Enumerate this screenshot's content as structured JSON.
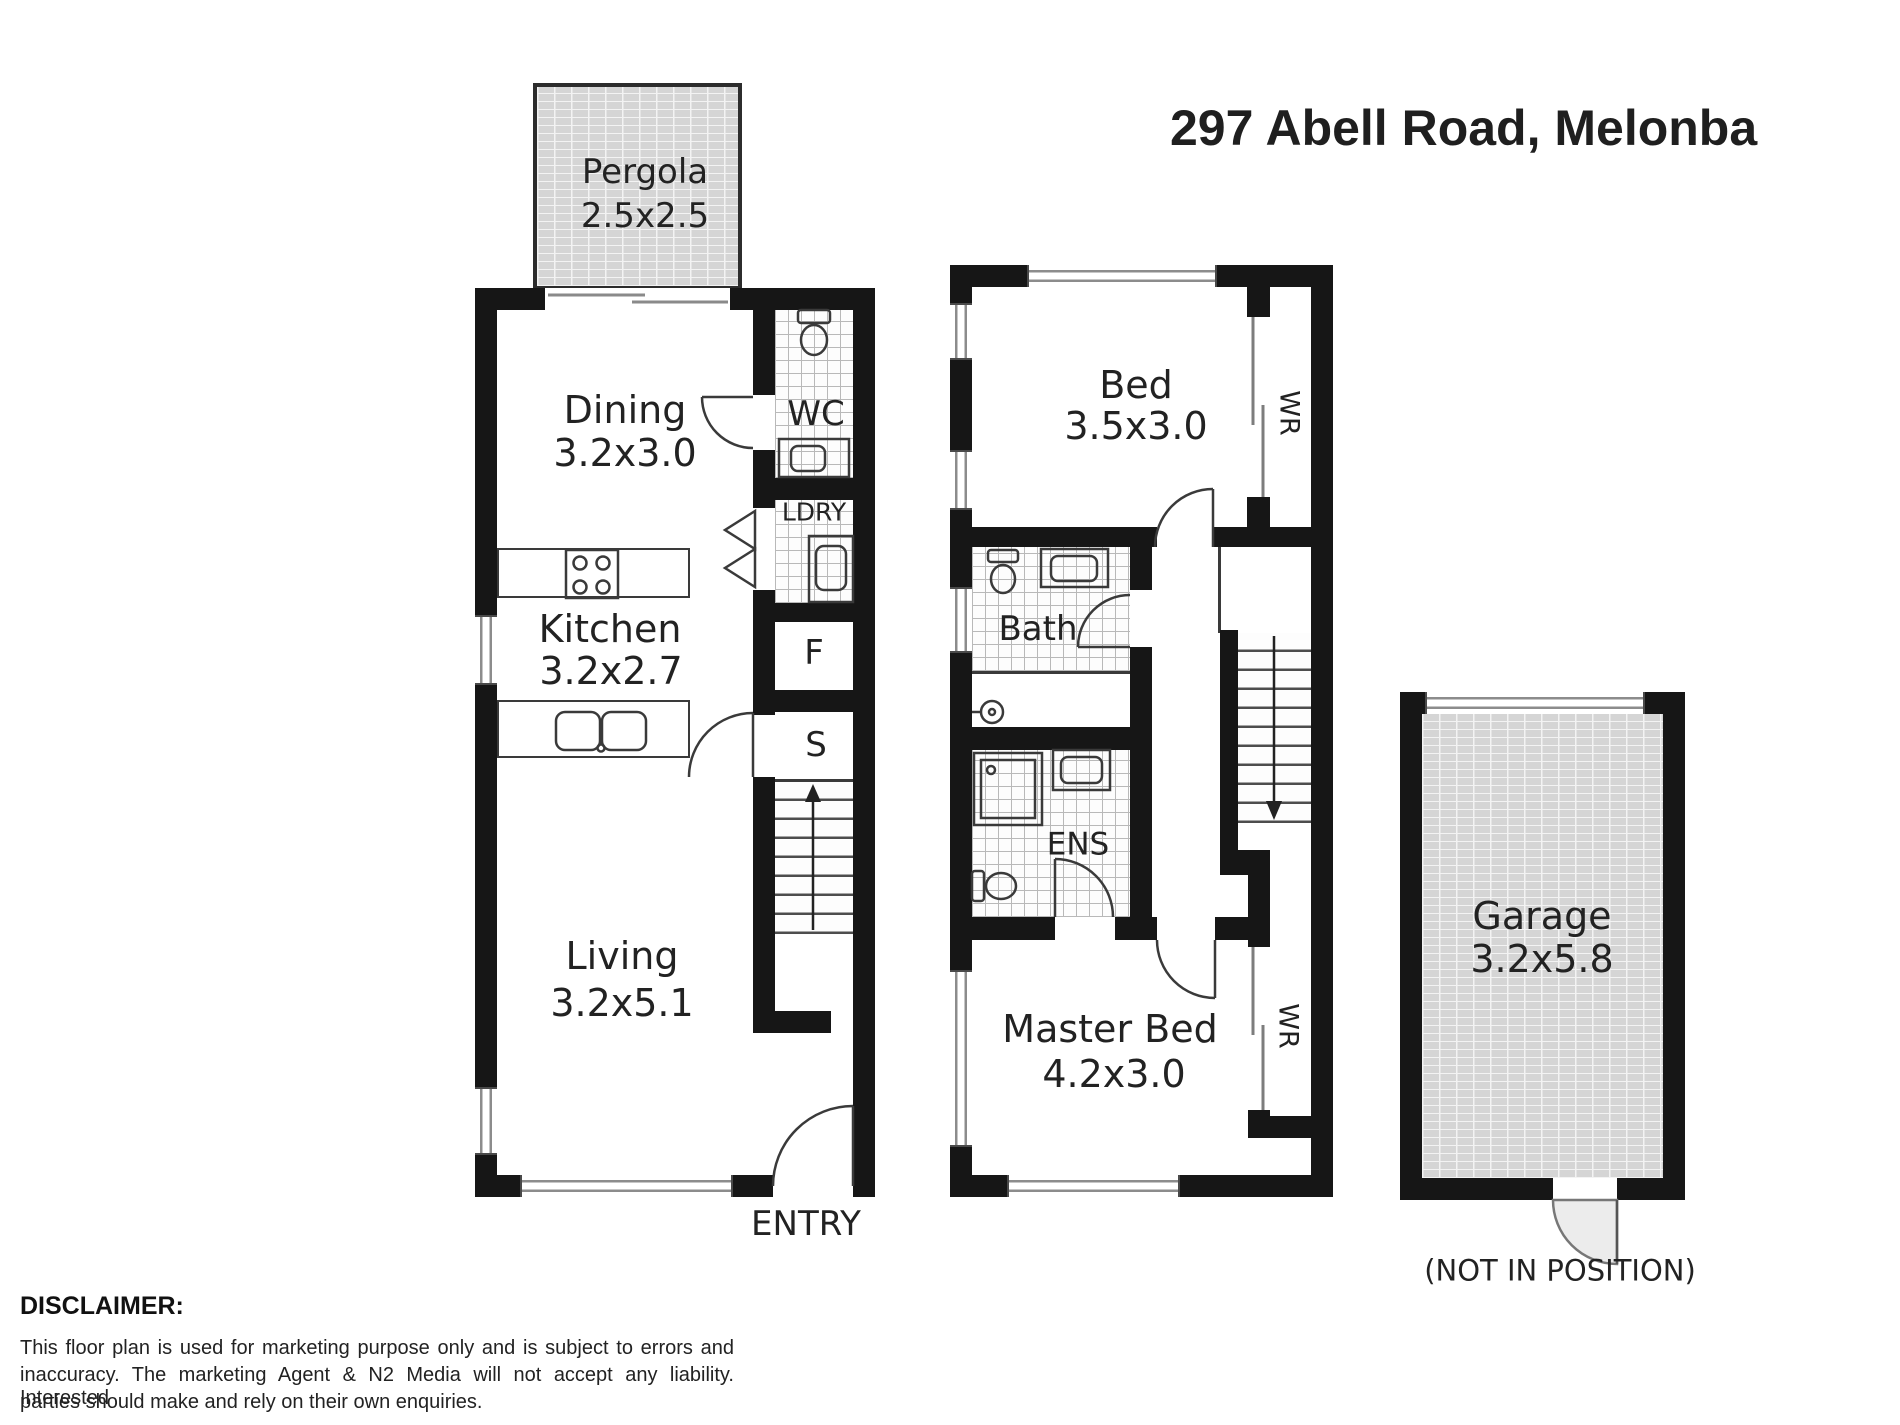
{
  "title": "297 Abell Road, Melonba",
  "entry": "ENTRY",
  "garage_note": "(NOT IN POSITION)",
  "disclaimer": {
    "heading": "DISCLAIMER:",
    "line1": "This floor plan is used for marketing purpose only and is subject to errors and",
    "line2": "inaccuracy. The marketing Agent & N2 Media will not accept any liability. Interested",
    "line3": "parties should make and rely on their own enquiries."
  },
  "rooms": {
    "pergola": {
      "name": "Pergola",
      "dims": "2.5x2.5"
    },
    "dining": {
      "name": "Dining",
      "dims": "3.2x3.0"
    },
    "wc": {
      "name": "WC"
    },
    "ldry": {
      "name": "LDRY"
    },
    "fridge": {
      "name": "F"
    },
    "store": {
      "name": "S"
    },
    "kitchen": {
      "name": "Kitchen",
      "dims": "3.2x2.7"
    },
    "living": {
      "name": "Living",
      "dims": "3.2x5.1"
    },
    "bed": {
      "name": "Bed",
      "dims": "3.5x3.0"
    },
    "bed_wr": {
      "name": "WR"
    },
    "bath": {
      "name": "Bath"
    },
    "ens": {
      "name": "ENS"
    },
    "master": {
      "name": "Master Bed",
      "dims": "4.2x3.0"
    },
    "master_wr": {
      "name": "WR"
    },
    "garage": {
      "name": "Garage",
      "dims": "3.2x5.8"
    }
  },
  "colors": {
    "wall": "#161616",
    "brick_fill": "#d5d5d5",
    "tile_line": "#b9b9b9",
    "fixture_line": "#3a3a3a"
  }
}
